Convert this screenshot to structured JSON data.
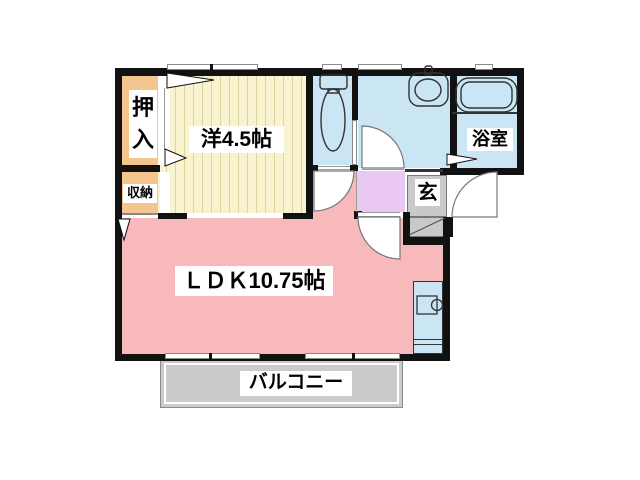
{
  "plan": {
    "title": "1LDK floor plan",
    "rooms": {
      "oshiire": {
        "label": "押入"
      },
      "western": {
        "label": "洋4.5帖"
      },
      "shunou": {
        "label": "収納"
      },
      "ldk": {
        "label": "ＬＤＫ10.75帖"
      },
      "genkan": {
        "label": "玄"
      },
      "bathroom": {
        "label": "浴室"
      },
      "balcony": {
        "label": "バルコニー"
      }
    },
    "fixtures": {
      "toilet": "toilet-icon",
      "washbasin": "washbasin-icon",
      "bathtub": "bathtub-icon",
      "kitchen_sink": "kitchen-sink-icon"
    }
  },
  "colors": {
    "wall": "#111111",
    "closet_fill": "#f2c68e",
    "western_fill": "#f9f4cf",
    "western_stripe": "#ddd5a0",
    "ldk_fill": "#f7b9bb",
    "water_fill": "#cae6f4",
    "hall_fill": "#e9c9f1",
    "entry_fill": "#c9c9c9",
    "balcony_fill": "#cbcbcb",
    "label_bg": "#ffffff",
    "outline": "#555555"
  }
}
